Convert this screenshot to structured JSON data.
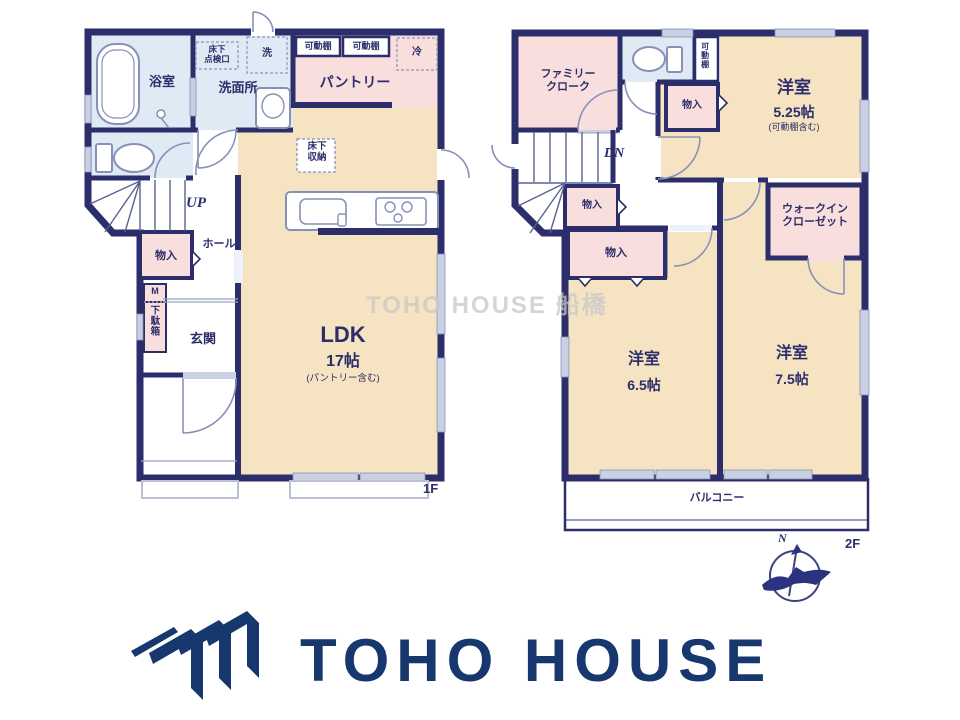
{
  "colors": {
    "wall_navy": "#2b2e6b",
    "room_tan": "#f6e3c1",
    "room_pink": "#f9dede",
    "room_blue": "#dfeaf5",
    "fixture_slate": "#8791b8",
    "window_gray": "#c9d0e2",
    "logo_navy": "#17386e",
    "watermark_gray": "#c8c8c8"
  },
  "watermark": "TOHO HOUSE 船橋",
  "floor1": {
    "floor_label": "1F",
    "bath": "浴室",
    "underfloor_hatch_l1": "床下",
    "underfloor_hatch_l2": "点検口",
    "washer": "洗",
    "washroom": "洗面所",
    "movable_shelf": "可動棚",
    "fridge": "冷",
    "pantry": "パントリー",
    "underfloor_storage_l1": "床下",
    "underfloor_storage_l2": "収納",
    "up": "UP",
    "hall": "ホール",
    "storage": "物入",
    "meter": "M",
    "shoe_cabinet": "下駄箱",
    "entrance": "玄関",
    "ldk": "LDK",
    "ldk_size": "17帖",
    "ldk_note": "(パントリー含む)"
  },
  "floor2": {
    "floor_label": "2F",
    "family_cloak_l1": "ファミリー",
    "family_cloak_l2": "クローク",
    "movable_shelf": "可動棚",
    "storage": "物入",
    "dn": "DN",
    "western_a": "洋室",
    "western_a_size": "5.25帖",
    "western_a_note": "(可動棚含む)",
    "wic_l1": "ウォークイン",
    "wic_l2": "クローゼット",
    "western_b": "洋室",
    "western_b_size": "6.5帖",
    "western_c": "洋室",
    "western_c_size": "7.5帖",
    "balcony": "バルコニー"
  },
  "compass": {
    "north": "N"
  },
  "logo": {
    "text": "TOHO HOUSE"
  }
}
